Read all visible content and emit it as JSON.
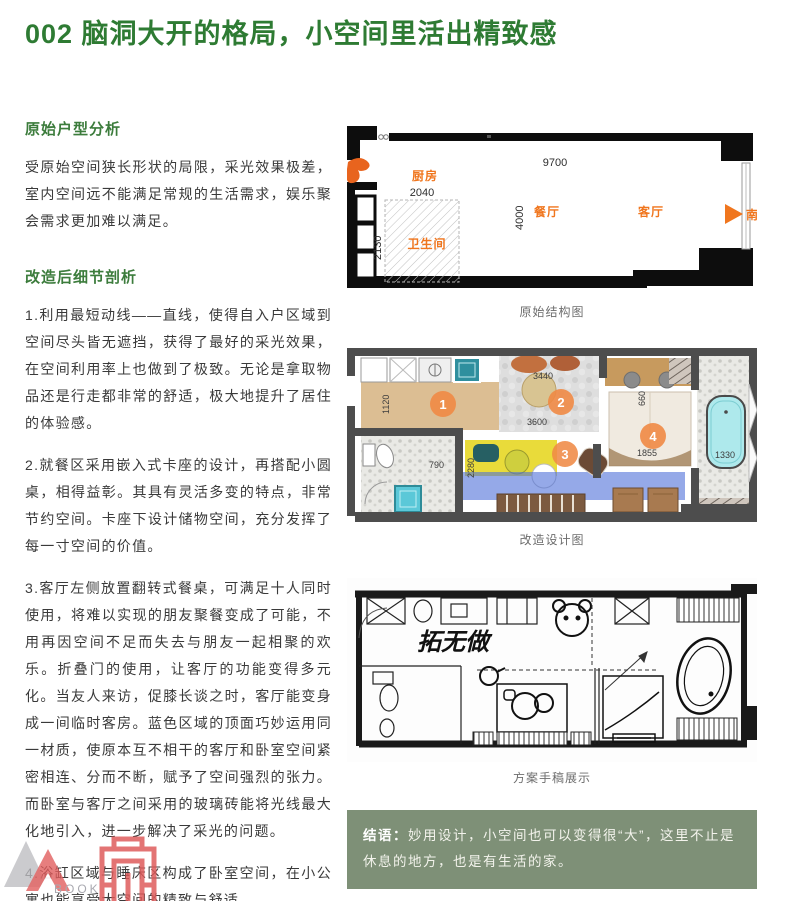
{
  "page": {
    "title": "002 脑洞大开的格局，小空间里活出精致感"
  },
  "colors": {
    "title_green": "#2e7b33",
    "accent_orange": "#f0761e",
    "box_green": "#7e9077",
    "highlight_yellow": "#e8d92f",
    "highlight_blue": "#4f6fd8"
  },
  "left": {
    "section1": {
      "heading": "原始户型分析",
      "body": "受原始空间狭长形状的局限，采光效果极差，室内空间远不能满足常规的生活需求，娱乐聚会需求更加难以满足。"
    },
    "section2": {
      "heading": "改造后细节剖析",
      "paragraphs": [
        "1.利用最短动线——直线，使得自入户区域到空间尽头皆无遮挡，获得了最好的采光效果，在空间利用率上也做到了极致。无论是拿取物品还是行走都非常的舒适，极大地提升了居住的体验感。",
        "2.就餐区采用嵌入式卡座的设计，再搭配小圆桌，相得益彰。其具有灵活多变的特点，非常节约空间。卡座下设计储物空间，充分发挥了每一寸空间的价值。",
        "3.客厅左侧放置翻转式餐桌，可满足十人同时使用，将难以实现的朋友聚餐变成了可能，不用再因空间不足而失去与朋友一起相聚的欢乐。折叠门的使用，让客厅的功能变得多元化。当友人来访，促膝长谈之时，客厅能变身成一间临时客房。蓝色区域的顶面巧妙运用同一材质，使原本互不相干的客厅和卧室空间紧密相连、分而不断，赋予了空间强烈的张力。而卧室与客厅之间采用的玻璃砖能将光线最大化地引入，进一步解决了采光的问题。",
        "4.浴缸区域与睡床区构成了卧室空间，在小公寓也能享受大空间的精致与舒适。"
      ]
    }
  },
  "plan_original": {
    "caption": "原始结构图",
    "rooms": {
      "kitchen": "厨房",
      "dining": "餐厅",
      "living": "客厅",
      "bathroom": "卫生间"
    },
    "dimensions": {
      "total_width": "9700",
      "kitchen_width": "2040",
      "depth": "4000",
      "bathroom_depth": "2130"
    },
    "compass_south": "南"
  },
  "plan_redesign": {
    "caption": "改造设计图",
    "markers": [
      "1",
      "2",
      "3",
      "4"
    ],
    "dimensions": {
      "entry": "1120",
      "corridor": "3600",
      "table": "3440",
      "banquette_depth": "2280",
      "bathroom": "790",
      "bed": "1855",
      "bathtub": "1330",
      "bed_width": "660"
    }
  },
  "plan_sketch": {
    "caption": "方案手稿展示",
    "signature": "拓无做"
  },
  "conclusion": {
    "label": "结语：",
    "text": "妙用设计，小空间也可以变得很“大”，这里不止是休息的地方，也是有生活的家。"
  },
  "watermark": {
    "text": "BOOK"
  }
}
